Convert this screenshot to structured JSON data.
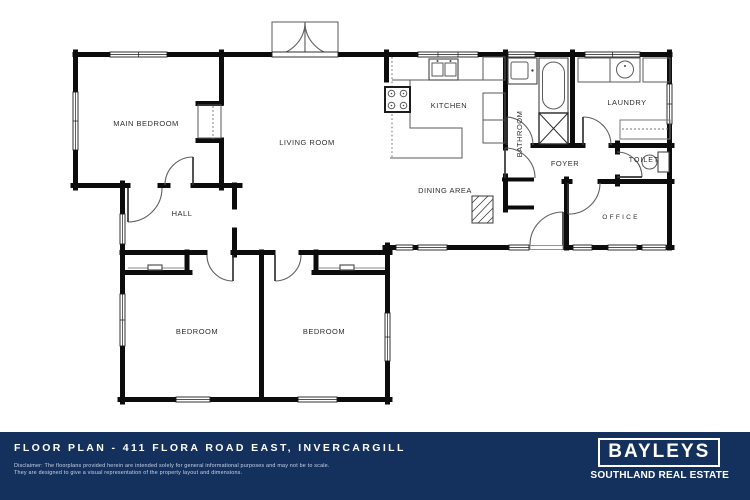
{
  "plan": {
    "labels": {
      "main_bedroom": "MAIN BEDROOM",
      "living_room": "LIVING ROOM",
      "kitchen": "KITCHEN",
      "bathroom": "BATHROOM",
      "laundry": "LAUNDRY",
      "foyer": "FOYER",
      "toilet": "TOILET",
      "dining_area": "DINING AREA",
      "hall": "HALL",
      "office": "OFFICE",
      "bedroom_left": "BEDROOM",
      "bedroom_right": "BEDROOM"
    },
    "wall_color": "#0c0c0c",
    "background": "#ffffff"
  },
  "footer": {
    "title": "FLOOR PLAN - 411 FLORA ROAD EAST, INVERCARGILL",
    "disclaimer_line1": "Disclaimer: The floorplans provided herein are intended solely for general informational purposes and may not be to scale.",
    "disclaimer_line2": "They are designed to give a visual representation of the property layout and dimensions.",
    "background": "#14315e",
    "text_color": "#ffffff"
  },
  "logo": {
    "brand": "BAYLEYS",
    "subtitle": "SOUTHLAND REAL ESTATE"
  }
}
